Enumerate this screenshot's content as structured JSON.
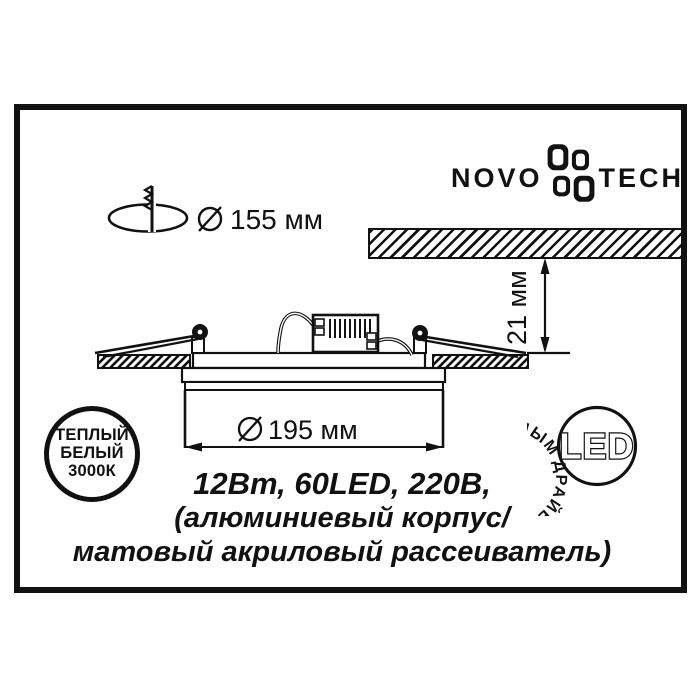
{
  "logo": {
    "left": "NOVO",
    "right": "TECH"
  },
  "cutout": {
    "label": "155 мм"
  },
  "recess_depth": {
    "label": "21 мм"
  },
  "overall_diameter": {
    "label": "195 мм"
  },
  "warm_white_badge": {
    "line1": "ТЕПЛЫЙ",
    "line2": "БЕЛЫЙ",
    "line3": "3000К"
  },
  "led_badge": {
    "ring_text": "ДРАЙВЕРОМ СО ВСТРОЕННЫМ",
    "center_text": "LED"
  },
  "specs": {
    "line1": "12Вт, 60LED, 220В,",
    "line2": "(алюминиевый корпус/",
    "line3": "матовый акриловый рассеиватель)"
  },
  "colors": {
    "ink": "#111111",
    "paper": "#ffffff"
  }
}
